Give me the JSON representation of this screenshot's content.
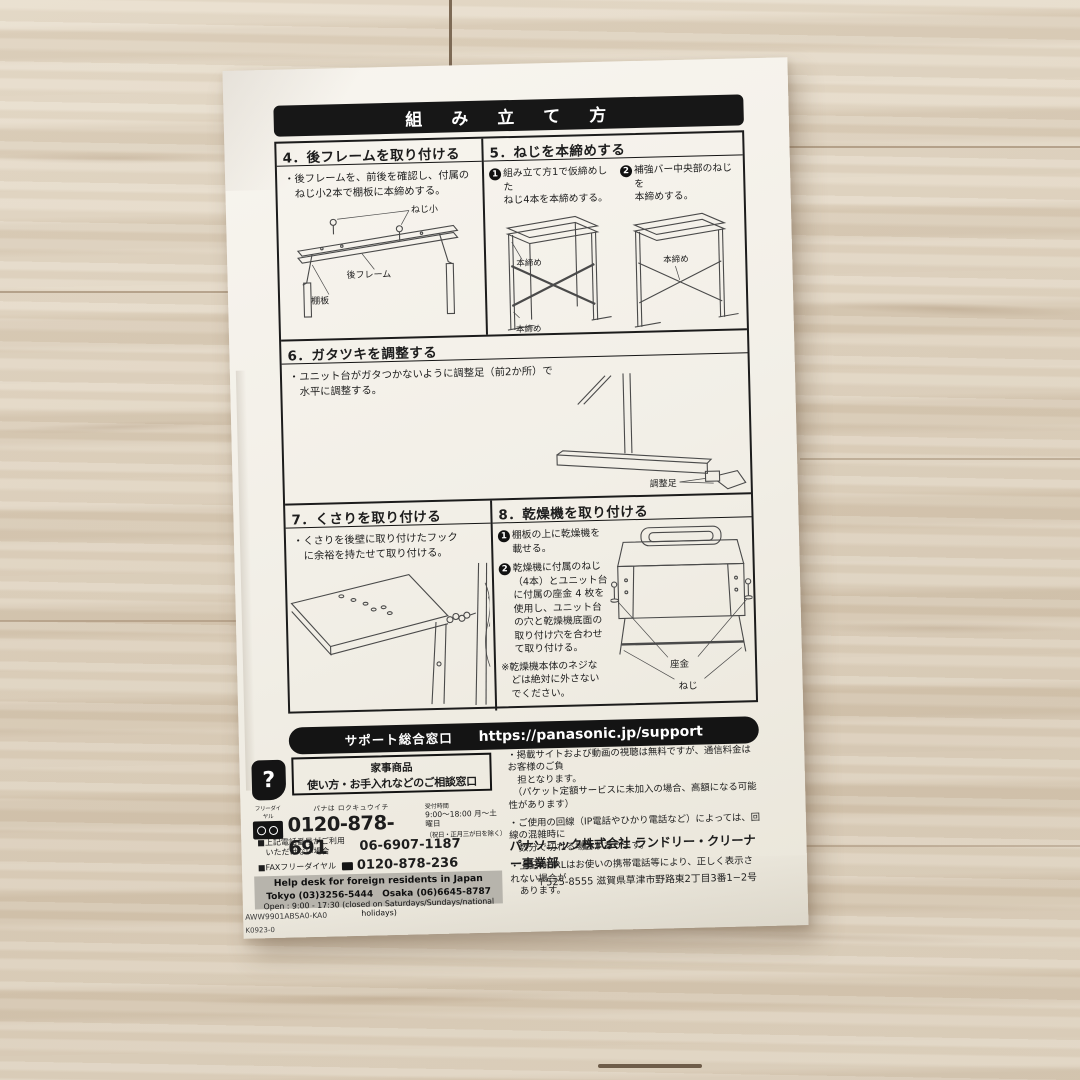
{
  "page": {
    "title": "組　み　立　て　方"
  },
  "s4": {
    "heading": "4．後フレームを取り付ける",
    "body": "・後フレームを、前後を確認し、付属の\n　ねじ小2本で棚板に本締めする。",
    "labels": {
      "screw": "ねじ小",
      "frame": "後フレーム",
      "shelf": "棚板"
    }
  },
  "s5": {
    "heading": "5．ねじを本締めする",
    "steps": [
      {
        "num": "1",
        "text": "組み立て方1で仮締めした\nねじ4本を本締めする。"
      },
      {
        "num": "2",
        "text": "補強バー中央部のねじを\n本締めする。"
      }
    ],
    "labels": {
      "a": "本締め",
      "b": "本締め",
      "c": "本締め"
    }
  },
  "s6": {
    "heading": "6．ガタツキを調整する",
    "body": "・ユニット台がガタつかないように調整足（前2か所）で\n　水平に調整する。",
    "label_foot": "調整足"
  },
  "s7": {
    "heading": "7．くさりを取り付ける",
    "body": "・くさりを後壁に取り付けたフック\n　に余裕を持たせて取り付ける。"
  },
  "s8": {
    "heading": "8．乾燥機を取り付ける",
    "steps": [
      {
        "num": "1",
        "text": "棚板の上に乾燥機を\n載せる。"
      },
      {
        "num": "2",
        "text": "乾燥機に付属のねじ\n（4本）とユニット台\nに付属の座金 4 枚を\n使用し、ユニット台\nの穴と乾燥機底面の\n取り付け穴を合わせ\nて取り付ける。"
      }
    ],
    "note": "※乾燥機本体のネジな\n　どは絶対に外さない\n　でください。",
    "labels": {
      "washer": "座金",
      "screw": "ねじ"
    }
  },
  "support": {
    "window_label": "サポート総合窓口",
    "url": "https://panasonic.jp/support"
  },
  "contact": {
    "mark": "?",
    "box_line1": "家事商品",
    "box_line2": "使い方・お手入れなどのご相談窓口",
    "freedial_label": "フリーダイヤル",
    "phone_reading": "パナは ロクキュウイチ",
    "phone_main": "0120-878-691",
    "hours_label": "受付時間",
    "hours_main": "9:00～18:00 月～土曜日",
    "hours_note": "（祝日・正月三が日を除く）",
    "alt_label": "■上記電話番号がご利用\n　いただけない場合",
    "alt_number": "06-6907-1187",
    "fax_label": "■FAXフリーダイヤル",
    "fax_number": "0120-878-236",
    "help_title": "Help desk for foreign residents in Japan",
    "help_phones": "Tokyo (03)3256-5444　Osaka (06)6645-8787",
    "help_open": "Open : 9:00 - 17:30 (closed on Saturdays/Sundays/national holidays)"
  },
  "notes": [
    "・掲載サイトおよび動画の視聴は無料ですが、通信料金はお客様のご負\n　担となります。\n　（パケット定額サービスに未加入の場合、高額になる可能性があります）",
    "・ご使用の回線（IP電話やひかり電話など）によっては、回線の混雑時に\n　数分で切れる場合があります。",
    "・上記のURLはお使いの携帯電話等により、正しく表示されない場合が\n　あります。"
  ],
  "company": {
    "name": "パナソニック株式会社 ランドリー・クリーナー事業部",
    "address": "〒525-8555 滋賀県草津市野路東2丁目3番1−2号"
  },
  "codes": [
    "AWW9901ABSA0-KA0",
    "K0923-0"
  ]
}
